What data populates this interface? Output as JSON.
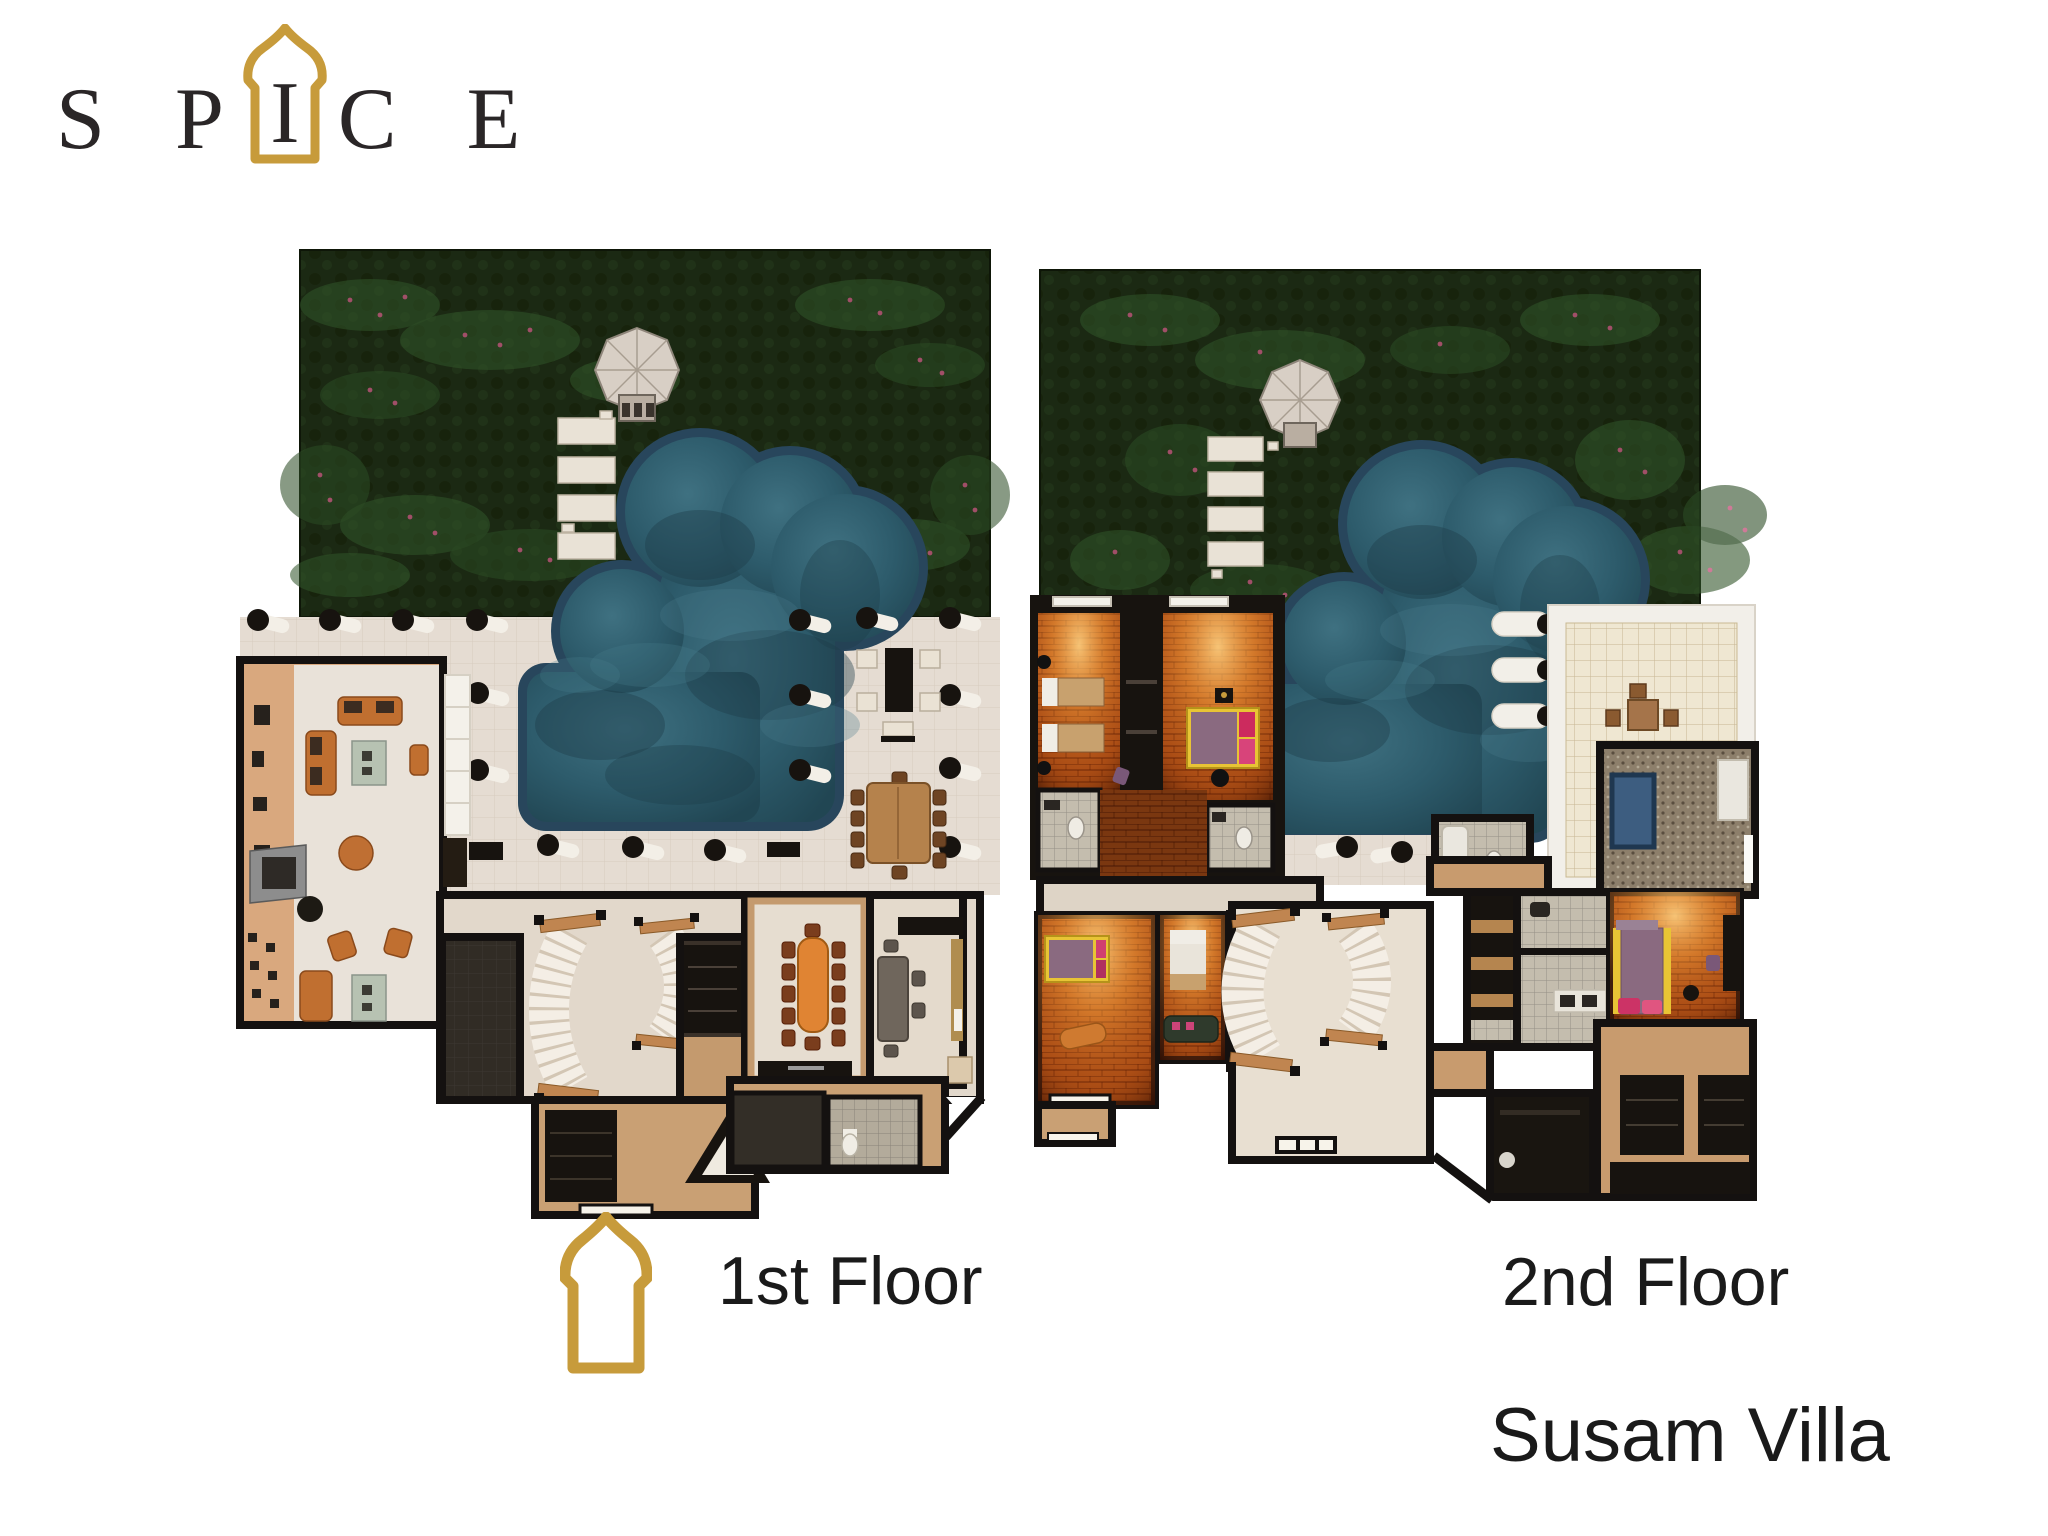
{
  "logo": {
    "letters_before": "S P",
    "arch_letter": "I",
    "letters_after": "C E"
  },
  "captions": {
    "first_floor": "1st Floor",
    "second_floor": "2nd Floor"
  },
  "villa_name": "Susam Villa",
  "icons": {
    "logo_frame": "moorish-arch-icon",
    "floor_marker": "moorish-arch-icon"
  },
  "palette": {
    "brand_gold": "#C79B3B",
    "text_black": "#1A1A1A",
    "logo_black": "#2A2627",
    "garden_green": "#1B2913",
    "pool_water": "#2D5B6B",
    "pool_border": "#28465C",
    "terrace_cream": "#E5DCD2",
    "wall_black": "#141110",
    "warm_room_glow": "#F09A40",
    "brick_orange": "#B0551B",
    "sofa_orange": "#C06F30",
    "wood_tan": "#C49A6E",
    "spa_tub_blue": "#3D5D80",
    "background": "#FFFFFF"
  }
}
